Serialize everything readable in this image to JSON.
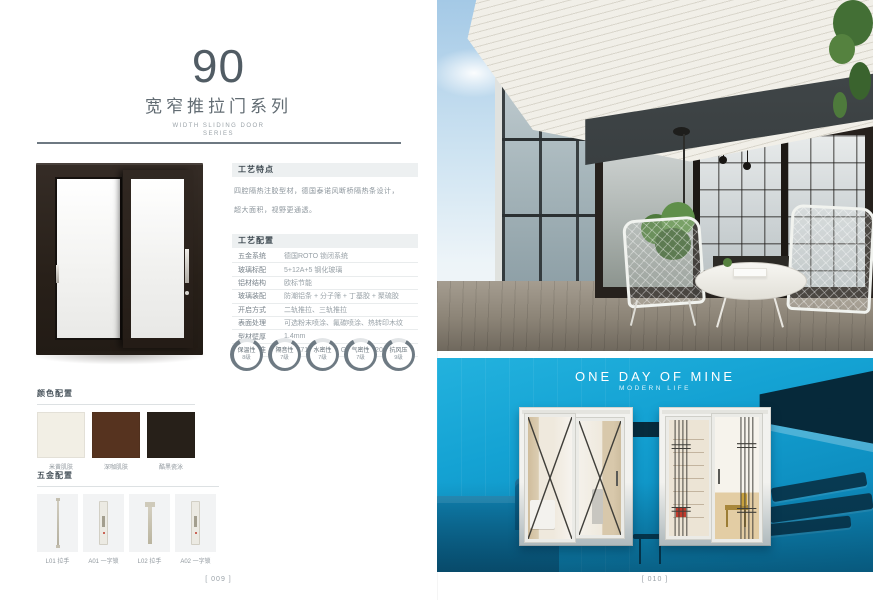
{
  "left": {
    "series_number": "90",
    "series_title": "宽窄推拉门系列",
    "series_subtitle_line1": "WIDTH SLIDING DOOR",
    "series_subtitle_line2": "SERIES",
    "craft_features": {
      "title": "工艺特点",
      "lines": [
        "四腔隔热注胶型材，德国泰诺风断桥隔热条设计，",
        "超大面积，视野更通透。"
      ]
    },
    "craft_config": {
      "title": "工艺配置",
      "rows": [
        {
          "label": "五金系统",
          "value": "德国ROTO 锁闭系统"
        },
        {
          "label": "玻璃标配",
          "value": "5+12A+5 钢化玻璃"
        },
        {
          "label": "铝材结构",
          "value": "欧标节能"
        },
        {
          "label": "玻璃装配",
          "value": "防潮铝条 + 分子筛 + 丁基胶 + 聚硫胶"
        },
        {
          "label": "开启方式",
          "value": "二轨推拉、三轨推拉"
        },
        {
          "label": "表面处理",
          "value": "可选粉末喷涂、氟碳喷涂、热转印木纹"
        },
        {
          "label": "型材壁厚",
          "value": "1.4mm"
        },
        {
          "label": "执行标准",
          "value": "GB/T7106-2008、GB/T8484-2008"
        }
      ]
    },
    "ratings": [
      {
        "name": "保温性",
        "grade": "8级"
      },
      {
        "name": "隔音性",
        "grade": "7级"
      },
      {
        "name": "水密性",
        "grade": "7级"
      },
      {
        "name": "气密性",
        "grade": "7级"
      },
      {
        "name": "抗风压",
        "grade": "9级"
      }
    ],
    "color_config": {
      "title": "颜色配置",
      "swatches": [
        {
          "label": "米黄肌肤",
          "color": "#f2efe5"
        },
        {
          "label": "深咖肌肤",
          "color": "#56331f"
        },
        {
          "label": "酷黑瓷泳",
          "color": "#272019"
        }
      ]
    },
    "hardware_config": {
      "title": "五金配置",
      "items": [
        {
          "label": "L01 拉手"
        },
        {
          "label": "A01 一字锁"
        },
        {
          "label": "L02 拉手"
        },
        {
          "label": "A02 一字锁"
        }
      ]
    },
    "page_number": "[ 009 ]"
  },
  "right": {
    "photo_title": "ONE DAY OF MINE",
    "photo_subtitle": "MODERN LIFE",
    "page_number": "[ 010 ]"
  }
}
